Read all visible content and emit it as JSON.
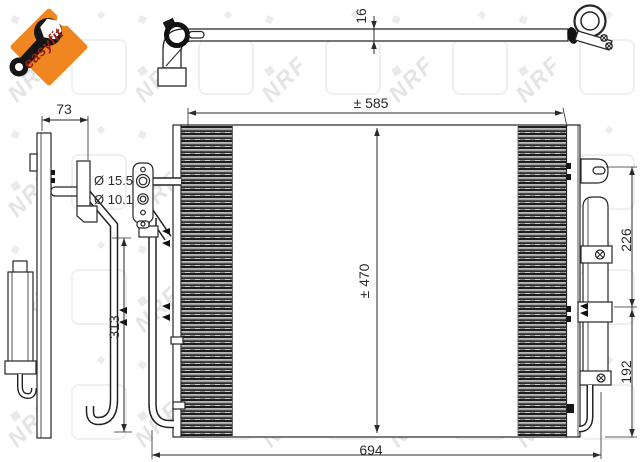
{
  "logo": {
    "brand": "easyfit",
    "diamond_color": "#f0861f",
    "text_color": "#942117"
  },
  "watermark": {
    "text": "NRF",
    "color": "#e4e4e4"
  },
  "dimensions": {
    "pipe_outer_diameter": "16",
    "mount_offset": "73",
    "port_large": "Ø 15.5",
    "port_small": "Ø 10.1",
    "side_span": "313",
    "core_width": "± 585",
    "core_height": "± 470",
    "overall_width": "694",
    "upper_span": "226",
    "lower_span": "192"
  }
}
